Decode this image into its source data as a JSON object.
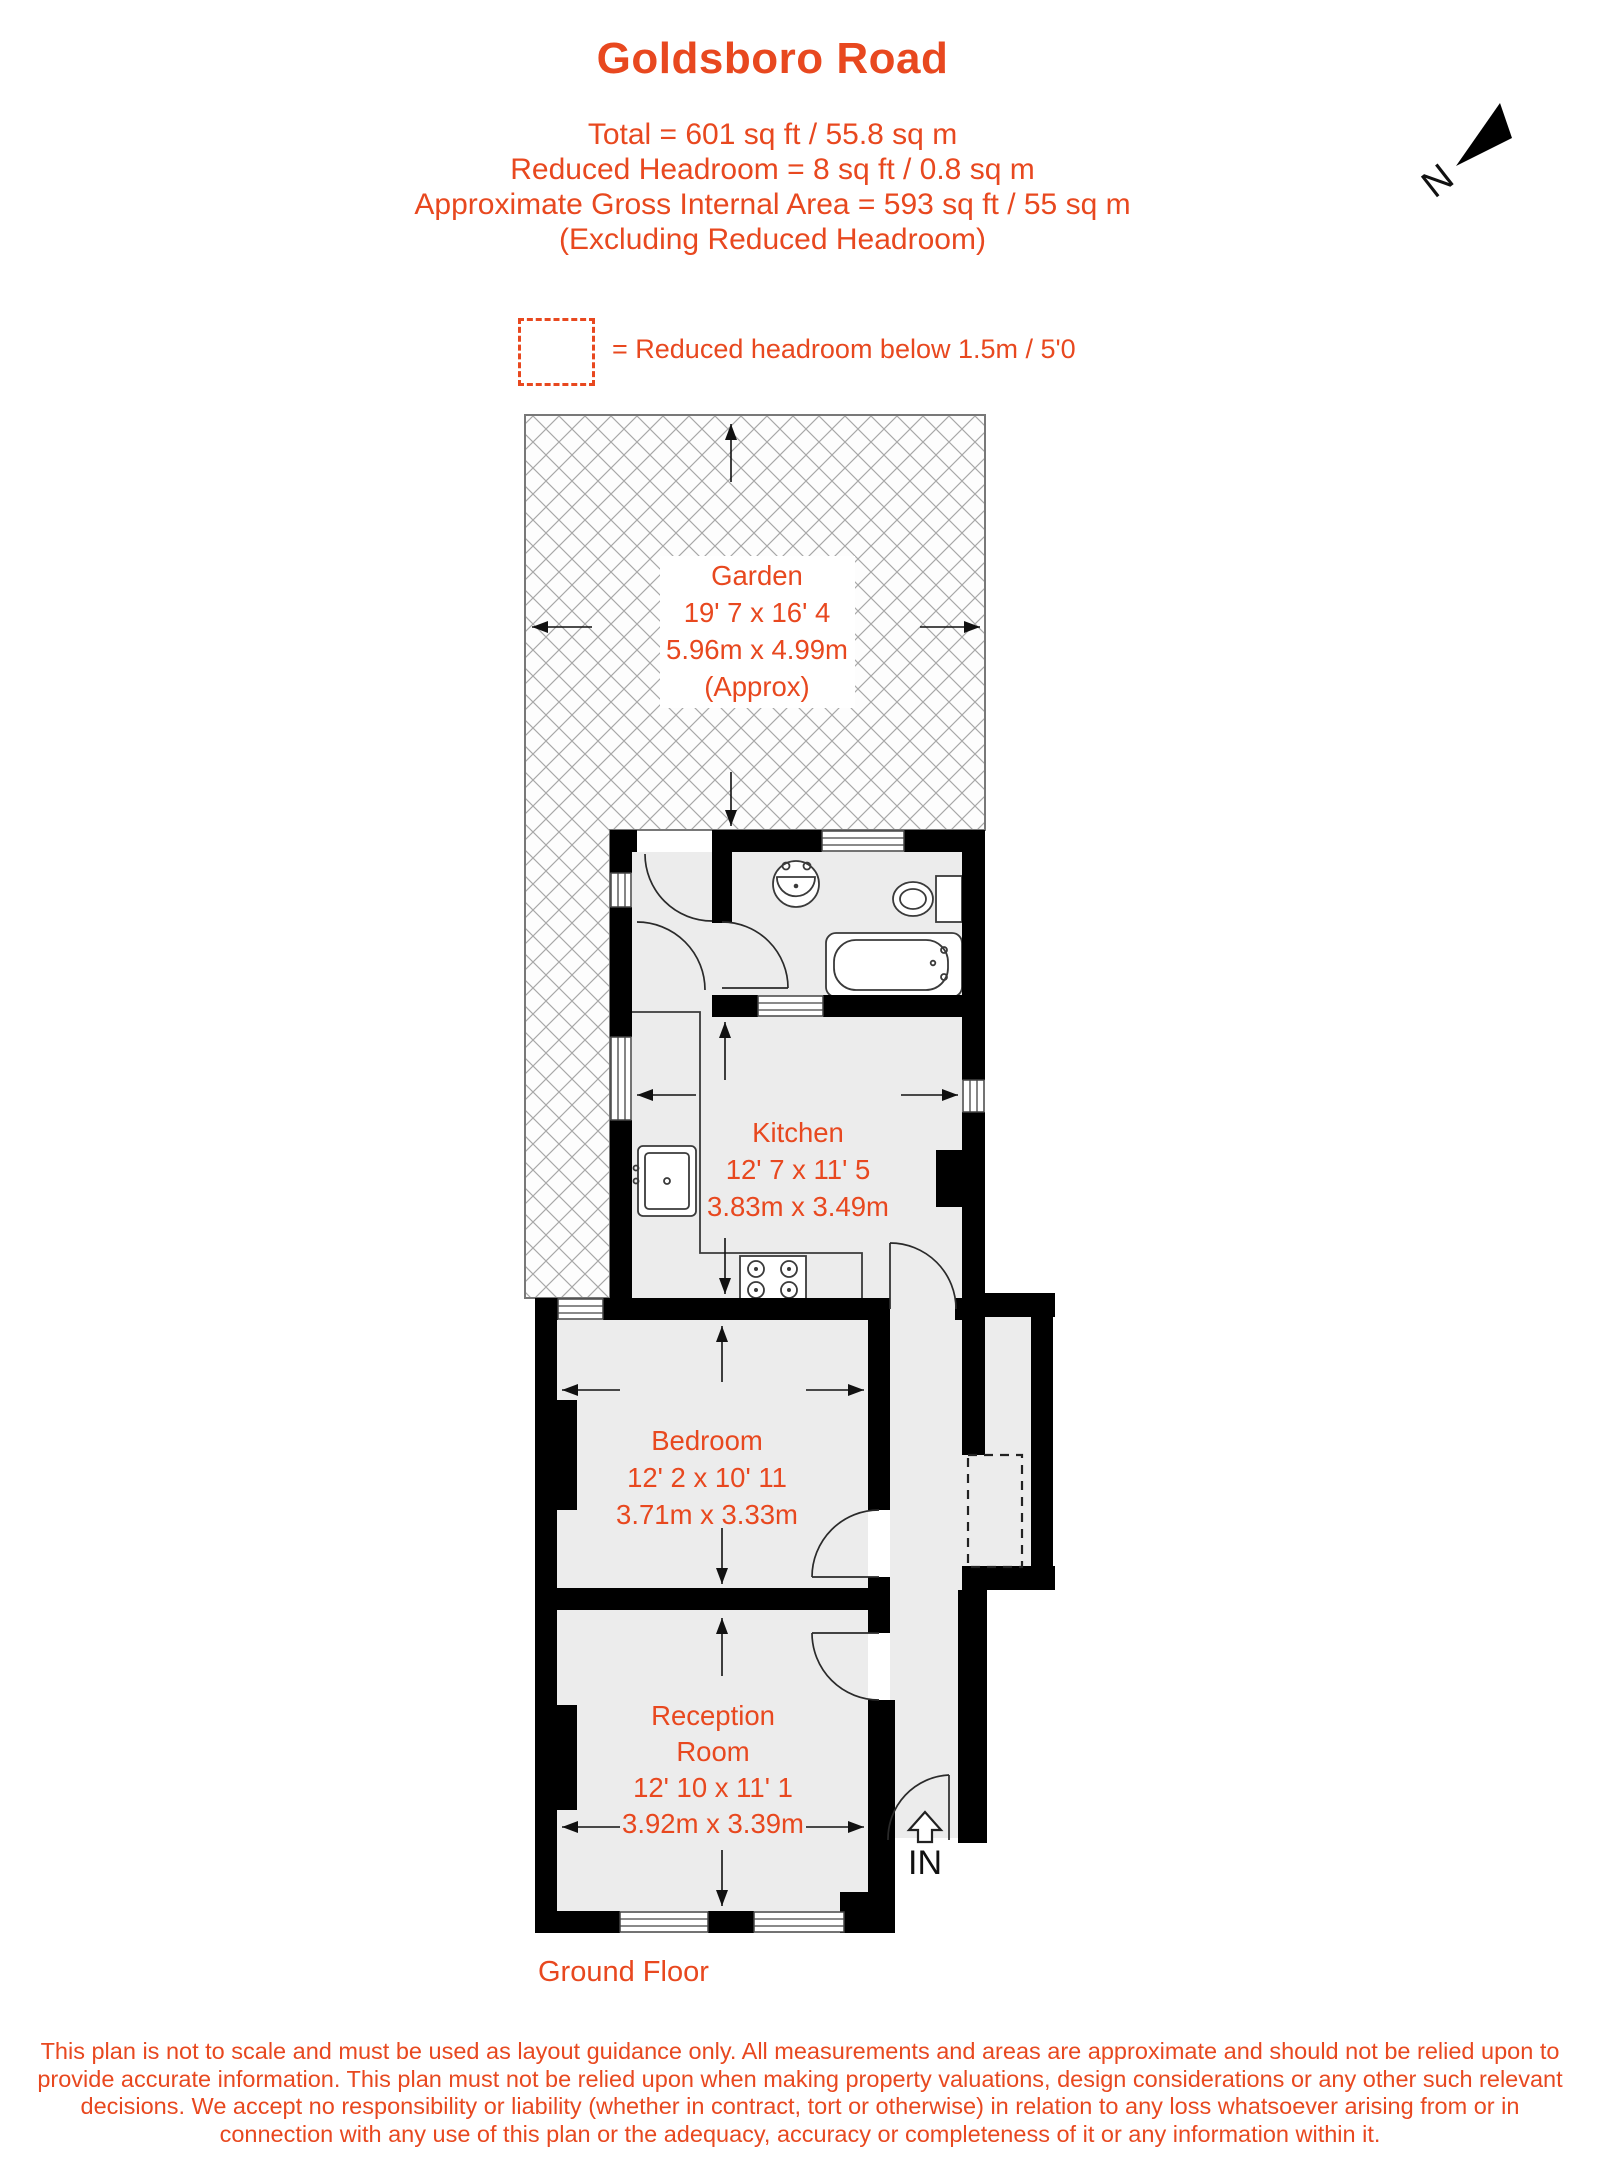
{
  "colors": {
    "accent": "#e8481f",
    "wall": "#000000",
    "floor": "#ececec",
    "hatch_line": "#a7a7a7"
  },
  "header": {
    "title": "Goldsboro Road",
    "line1": "Total = 601 sq ft / 55.8 sq m",
    "line2": "Reduced Headroom = 8 sq ft / 0.8 sq m",
    "line3": "Approximate Gross Internal Area = 593 sq ft / 55 sq m",
    "line4": "(Excluding Reduced Headroom)"
  },
  "compass": {
    "label": "N"
  },
  "legend": {
    "text": "= Reduced headroom below 1.5m / 5'0"
  },
  "rooms": {
    "garden": {
      "name": "Garden",
      "imperial": "19' 7 x 16' 4",
      "metric": "5.96m x 4.99m",
      "note": "(Approx)"
    },
    "kitchen": {
      "name": "Kitchen",
      "imperial": "12' 7 x 11' 5",
      "metric": "3.83m x 3.49m"
    },
    "bedroom": {
      "name": "Bedroom",
      "imperial": "12' 2 x 10' 11",
      "metric": "3.71m x 3.33m"
    },
    "reception": {
      "name1": "Reception",
      "name2": "Room",
      "imperial": "12' 10 x 11' 1",
      "metric": "3.92m x 3.39m"
    }
  },
  "entrance": {
    "label": "IN"
  },
  "floor_label": "Ground Floor",
  "disclaimer": {
    "line1": "This plan is not to scale and must be used as layout guidance only. All measurements and areas are approximate and should not be relied upon to",
    "line2": "provide accurate information. This plan must not be relied upon when making property valuations, design considerations or any other such relevant",
    "line3": "decisions. We accept no responsibility or liability (whether in contract, tort or otherwise) in relation to any loss whatsoever arising from or in",
    "line4": "connection with any use of this plan or the adequacy, accuracy or completeness of it or any information within it."
  }
}
